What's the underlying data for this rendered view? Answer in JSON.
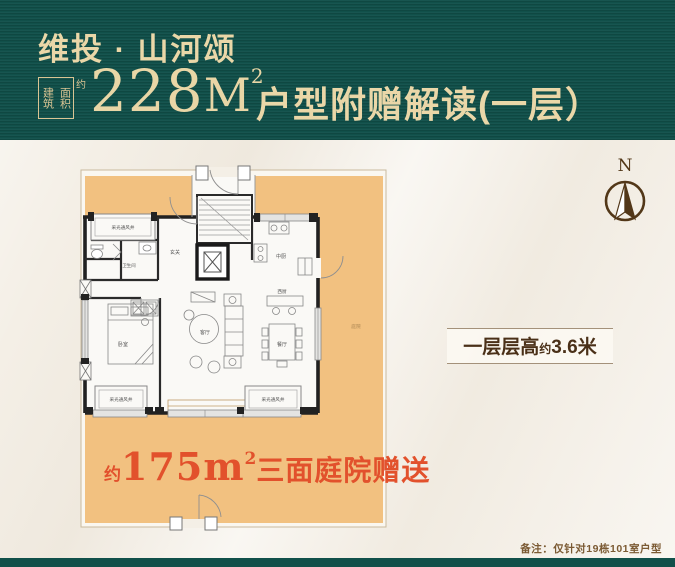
{
  "header": {
    "brand": "维投 · 山河颂",
    "seal": {
      "row1": "建筑",
      "row2": "面积",
      "approx": "约"
    },
    "area_value": "228",
    "area_unit": "M",
    "area_sup": "2",
    "subtitle": "户型附赠解读(一层）"
  },
  "plan": {
    "rooms": {
      "lightwell": "采光通风井",
      "bath": "卫生间",
      "foyer": "玄关",
      "kitchen_cn": "中厨",
      "kitchen_west": "西厨",
      "living": "客厅",
      "dining": "餐厅",
      "bedroom": "卧室",
      "courtyard": "庭院"
    }
  },
  "promo": {
    "approx": "约",
    "value": "175m",
    "sup": "2",
    "suffix": "三面庭院赠送"
  },
  "floor_height_badge": {
    "prefix": "一层层高",
    "approx": "约",
    "value": "3.6米"
  },
  "compass": {
    "label": "N"
  },
  "note": "备注：仅针对19栋101室户型",
  "colors": {
    "header_green": "#11504a",
    "gold_text": "#ead7a8",
    "courtyard_orange": "#f2c180",
    "promo_red": "#e2512c",
    "brown_accent": "#523718",
    "background_cream": "#f4efe6"
  }
}
